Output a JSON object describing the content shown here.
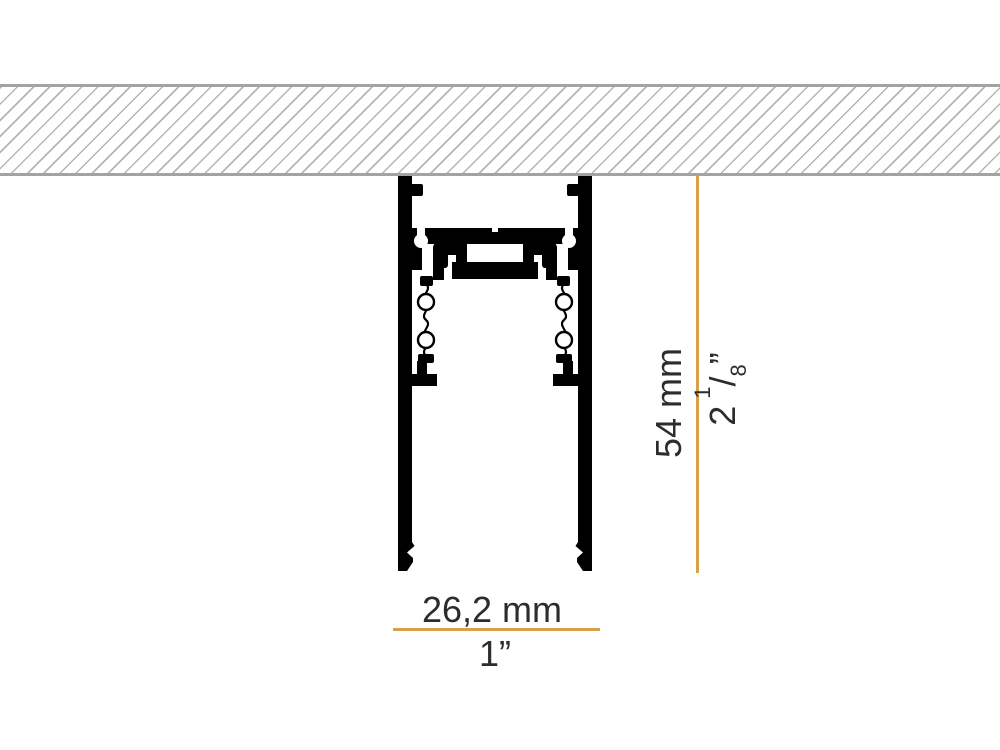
{
  "dimensions": {
    "height_mm": "54 mm",
    "height_in": {
      "whole": "2",
      "numerator": "1",
      "slash": "/",
      "denominator": "8",
      "unit": "”"
    },
    "width_mm": "26,2 mm",
    "width_in": "1”"
  },
  "colors": {
    "dimension_line": "#D7A14B",
    "profile": "#000000",
    "hatch_line": "#b5b5b5",
    "hatch_border": "#a3a3a3",
    "text": "#2d2d2d",
    "background": "#ffffff"
  }
}
